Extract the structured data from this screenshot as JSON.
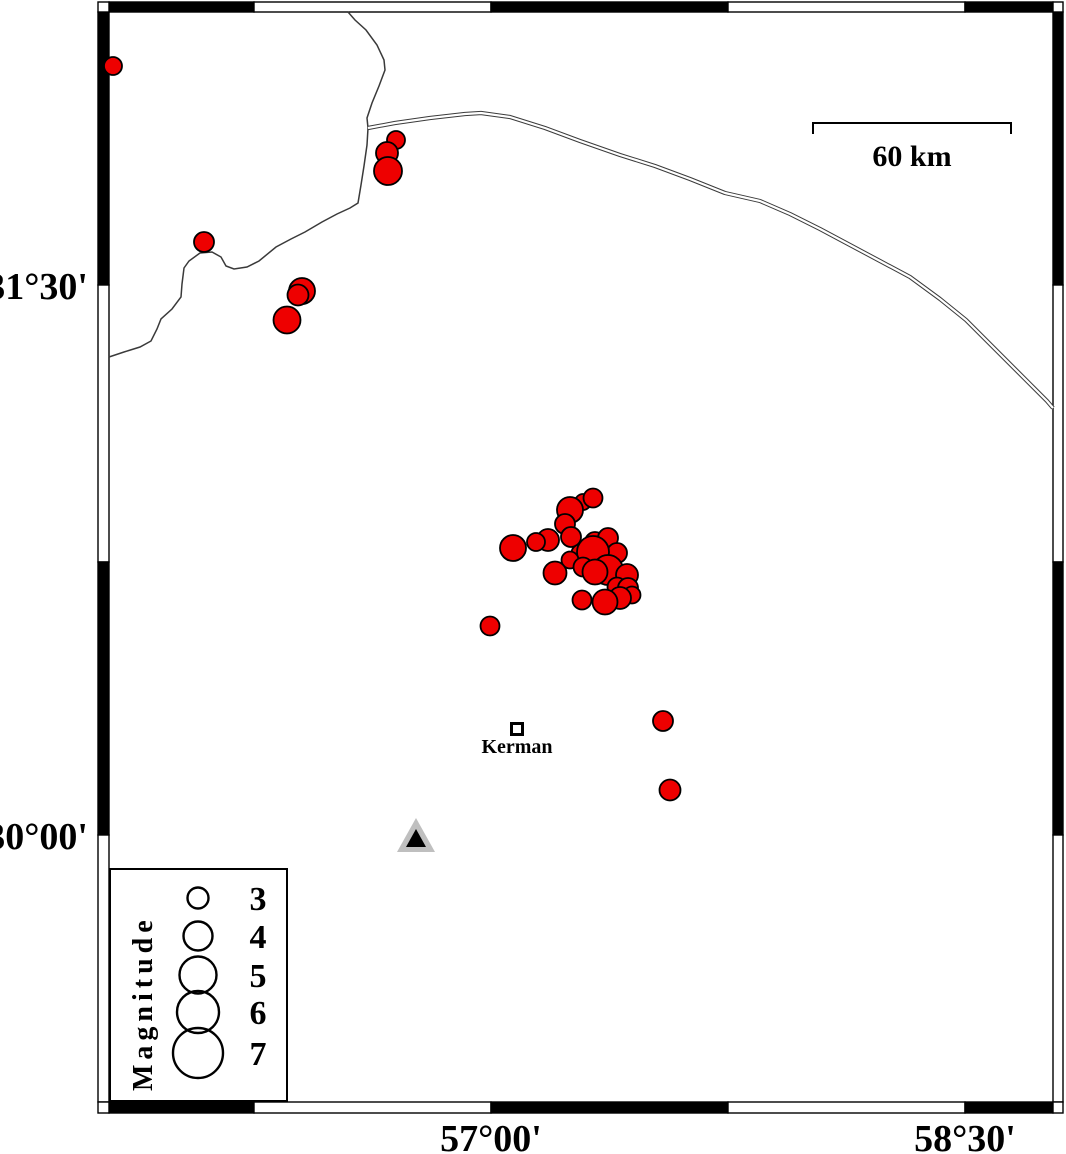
{
  "map": {
    "background": "#ffffff",
    "frame": {
      "stroke": "#000000",
      "outer": [
        98,
        2,
        1063,
        1113
      ],
      "inner": [
        109,
        12,
        1053,
        1102
      ],
      "x_ticks": [
        109,
        254,
        491,
        728,
        965,
        1053
      ],
      "y_ticks": [
        12,
        285,
        562,
        835,
        1102
      ]
    },
    "axis_labels": {
      "left": [
        {
          "text": "31°30'",
          "y": 285
        },
        {
          "text": "30°00'",
          "y": 835
        }
      ],
      "bottom": [
        {
          "text": "57°00'",
          "x": 491
        },
        {
          "text": "58°30'",
          "x": 965
        }
      ]
    },
    "scale_bar": {
      "label": "60 km",
      "x1": 813,
      "x2": 1011,
      "y": 123,
      "tick_drop": 11
    },
    "city": {
      "name": "Kerman",
      "x": 517,
      "y": 729,
      "marker_size": 11
    },
    "station": {
      "cx": 416,
      "apex_y": 818,
      "base_y": 852,
      "half_w": 19,
      "inner_apex_y": 829,
      "inner_base_y": 847,
      "inner_half_w": 10,
      "outer_color": "#bfbfbf",
      "inner_color": "#000000"
    },
    "legend": {
      "title": "Magnitude",
      "box": [
        110,
        869,
        287,
        1101
      ],
      "circle_x": 198,
      "label_x": 258,
      "entries": [
        {
          "magnitude": "3",
          "y": 898,
          "r": 10.5
        },
        {
          "magnitude": "4",
          "y": 936,
          "r": 14.5
        },
        {
          "magnitude": "5",
          "y": 975,
          "r": 18.5
        },
        {
          "magnitude": "6",
          "y": 1012,
          "r": 21
        },
        {
          "magnitude": "7",
          "y": 1053,
          "r": 25
        }
      ]
    },
    "earthquakes": {
      "fill": "#ee0000",
      "stroke": "#000000",
      "points": [
        [
          113,
          66,
          9
        ],
        [
          396,
          140,
          9
        ],
        [
          387,
          153,
          11
        ],
        [
          388,
          171,
          14
        ],
        [
          204,
          242,
          10
        ],
        [
          302,
          291,
          13
        ],
        [
          298,
          295,
          10.5
        ],
        [
          287,
          320,
          13.5
        ],
        [
          513,
          548,
          13
        ],
        [
          490,
          626,
          9.5
        ],
        [
          583,
          502,
          8
        ],
        [
          593,
          498,
          9.5
        ],
        [
          570,
          510,
          13
        ],
        [
          565,
          524,
          10
        ],
        [
          571,
          537,
          10
        ],
        [
          548,
          540,
          11
        ],
        [
          536,
          542,
          9
        ],
        [
          595,
          542,
          10
        ],
        [
          608,
          538,
          10
        ],
        [
          617,
          553,
          10
        ],
        [
          580,
          553,
          8.5
        ],
        [
          593,
          552,
          16
        ],
        [
          570,
          560,
          8.5
        ],
        [
          583,
          567,
          9.5
        ],
        [
          555,
          573,
          11.5
        ],
        [
          608,
          570,
          15
        ],
        [
          595,
          572,
          12.5
        ],
        [
          627,
          575,
          11
        ],
        [
          617,
          587,
          9.5
        ],
        [
          628,
          588,
          10
        ],
        [
          632,
          595,
          8.5
        ],
        [
          582,
          600,
          9.5
        ],
        [
          620,
          598,
          11
        ],
        [
          605,
          602,
          12.5
        ],
        [
          663,
          721,
          10
        ],
        [
          670,
          790,
          10.5
        ]
      ]
    },
    "lines": {
      "color": "#3a3a3a",
      "single": [
        [
          348,
          12
        ],
        [
          355,
          20
        ],
        [
          366,
          30
        ],
        [
          377,
          45
        ],
        [
          384,
          60
        ],
        [
          385,
          70
        ],
        [
          379,
          86
        ],
        [
          372,
          103
        ],
        [
          367,
          118
        ],
        [
          368,
          128
        ],
        [
          367,
          145
        ],
        [
          364,
          166
        ],
        [
          361,
          185
        ],
        [
          358,
          203
        ],
        [
          350,
          208
        ],
        [
          337,
          214
        ],
        [
          322,
          222
        ],
        [
          305,
          232
        ],
        [
          291,
          239
        ],
        [
          276,
          247
        ],
        [
          259,
          261
        ],
        [
          247,
          267
        ],
        [
          234,
          269
        ],
        [
          226,
          266
        ],
        [
          221,
          257
        ],
        [
          212,
          252
        ],
        [
          200,
          253
        ],
        [
          189,
          261
        ],
        [
          184,
          268
        ],
        [
          182,
          284
        ],
        [
          181,
          297
        ],
        [
          172,
          309
        ],
        [
          161,
          319
        ],
        [
          157,
          329
        ],
        [
          151,
          341
        ],
        [
          140,
          347
        ],
        [
          124,
          352
        ],
        [
          109,
          357
        ]
      ],
      "double": [
        [
          368,
          128
        ],
        [
          395,
          123
        ],
        [
          430,
          118
        ],
        [
          465,
          114
        ],
        [
          481,
          113
        ],
        [
          510,
          117
        ],
        [
          545,
          128
        ],
        [
          580,
          141
        ],
        [
          620,
          155
        ],
        [
          655,
          166
        ],
        [
          690,
          179
        ],
        [
          725,
          193
        ],
        [
          760,
          201
        ],
        [
          790,
          214
        ],
        [
          820,
          229
        ],
        [
          850,
          245
        ],
        [
          880,
          261
        ],
        [
          910,
          277
        ],
        [
          940,
          299
        ],
        [
          966,
          320
        ],
        [
          990,
          344
        ],
        [
          1012,
          366
        ],
        [
          1032,
          386
        ],
        [
          1047,
          401
        ],
        [
          1053,
          408
        ]
      ]
    }
  }
}
